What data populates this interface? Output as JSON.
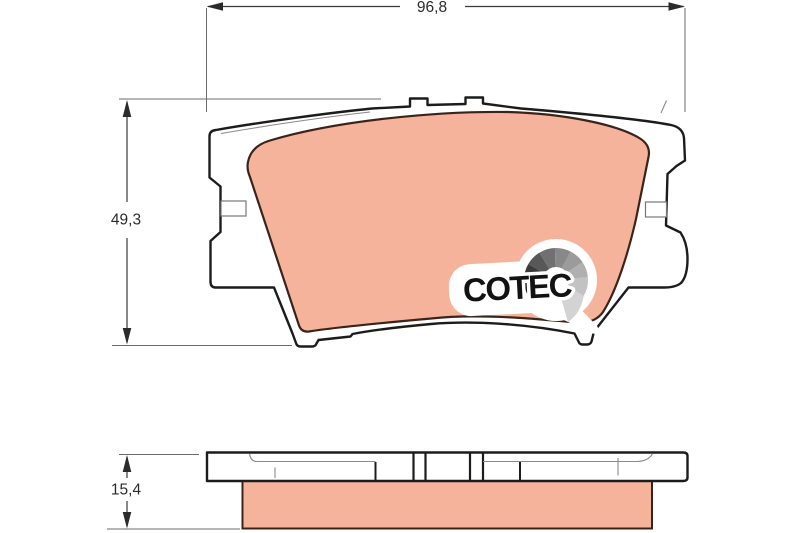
{
  "drawing": {
    "dimensions": {
      "width": "96,8",
      "height": "49,3",
      "thickness": "15,4"
    },
    "logo": {
      "text": "COTEC"
    },
    "colors": {
      "friction_material": "#f6b39c",
      "friction_outline": "#3a241a",
      "plate_outline": "#1c1c1c",
      "dimension_lines": "#3a3a3a",
      "background": "#ffffff"
    }
  }
}
